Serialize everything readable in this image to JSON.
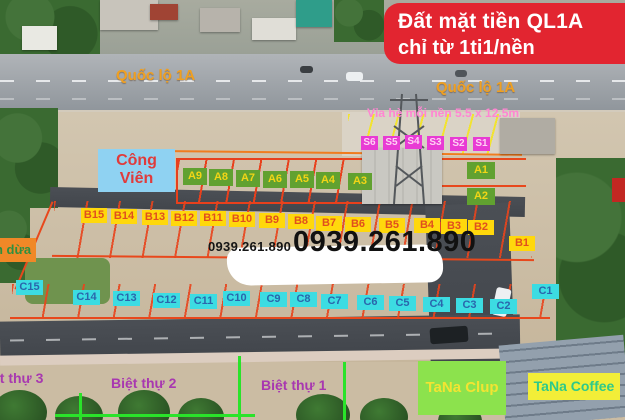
{
  "banner": {
    "line1": "Đất mặt tiền QL1A",
    "line2": "chỉ từ 1ti1/nền",
    "bg_color": "#e22530",
    "text_color": "#ffffff"
  },
  "highway": {
    "label_left": "Quốc lộ 1A",
    "label_right": "Quốc lộ 1A",
    "label_color": "#f0a021"
  },
  "sidewalk_note": {
    "text": "Vỉa hè mỗi nền 5.5 x 12.5m",
    "color": "#ff86d2"
  },
  "park": {
    "line1": "Công",
    "line2": "Viên",
    "bg_color": "#8fd2f2",
    "text_color": "#e03b3b"
  },
  "lots": {
    "s_row": [
      "S6",
      "S5",
      "S4",
      "S3",
      "S2",
      "S1"
    ],
    "s_style": {
      "bg": "#e83bd4",
      "text": "#ffd2f4"
    },
    "a_row": [
      "A9",
      "A8",
      "A7",
      "A6",
      "A5",
      "A4",
      "A3"
    ],
    "a_col": [
      "A1",
      "A2"
    ],
    "a_style": {
      "bg": "#61a130",
      "text": "#f2d516"
    },
    "b_row": [
      "B15",
      "B14",
      "B13",
      "B12",
      "B11",
      "B10",
      "B9",
      "B8",
      "B7",
      "B6",
      "B5",
      "B4",
      "B3",
      "B2"
    ],
    "b_corner": "B1",
    "b_style": {
      "bg": "#ffd80c",
      "text": "#e04f1e"
    },
    "c_row": [
      "C15",
      "C14",
      "C13",
      "C12",
      "C11",
      "C10",
      "C9",
      "C8",
      "C7",
      "C6",
      "C5",
      "C4",
      "C3",
      "C2"
    ],
    "c_corner": "C1",
    "c_style": {
      "bg": "#3cdce2",
      "text": "#2a66ac"
    }
  },
  "phone": {
    "small": "0939.261.890",
    "large": "0939.261.890"
  },
  "left_label": {
    "text": "n dừa",
    "bg_color": "#f08827",
    "text_color": "#2f8f3f"
  },
  "villas": {
    "v3": "Biệt thự 3",
    "v2": "Biệt thự 2",
    "v1": "Biệt thự 1",
    "text_color": "#a838b0"
  },
  "venues": {
    "club": "TaNa Clup",
    "club_bg": "#8ce24d",
    "coffee": "TaNa Coffee",
    "coffee_bg": "#f2ee38"
  }
}
